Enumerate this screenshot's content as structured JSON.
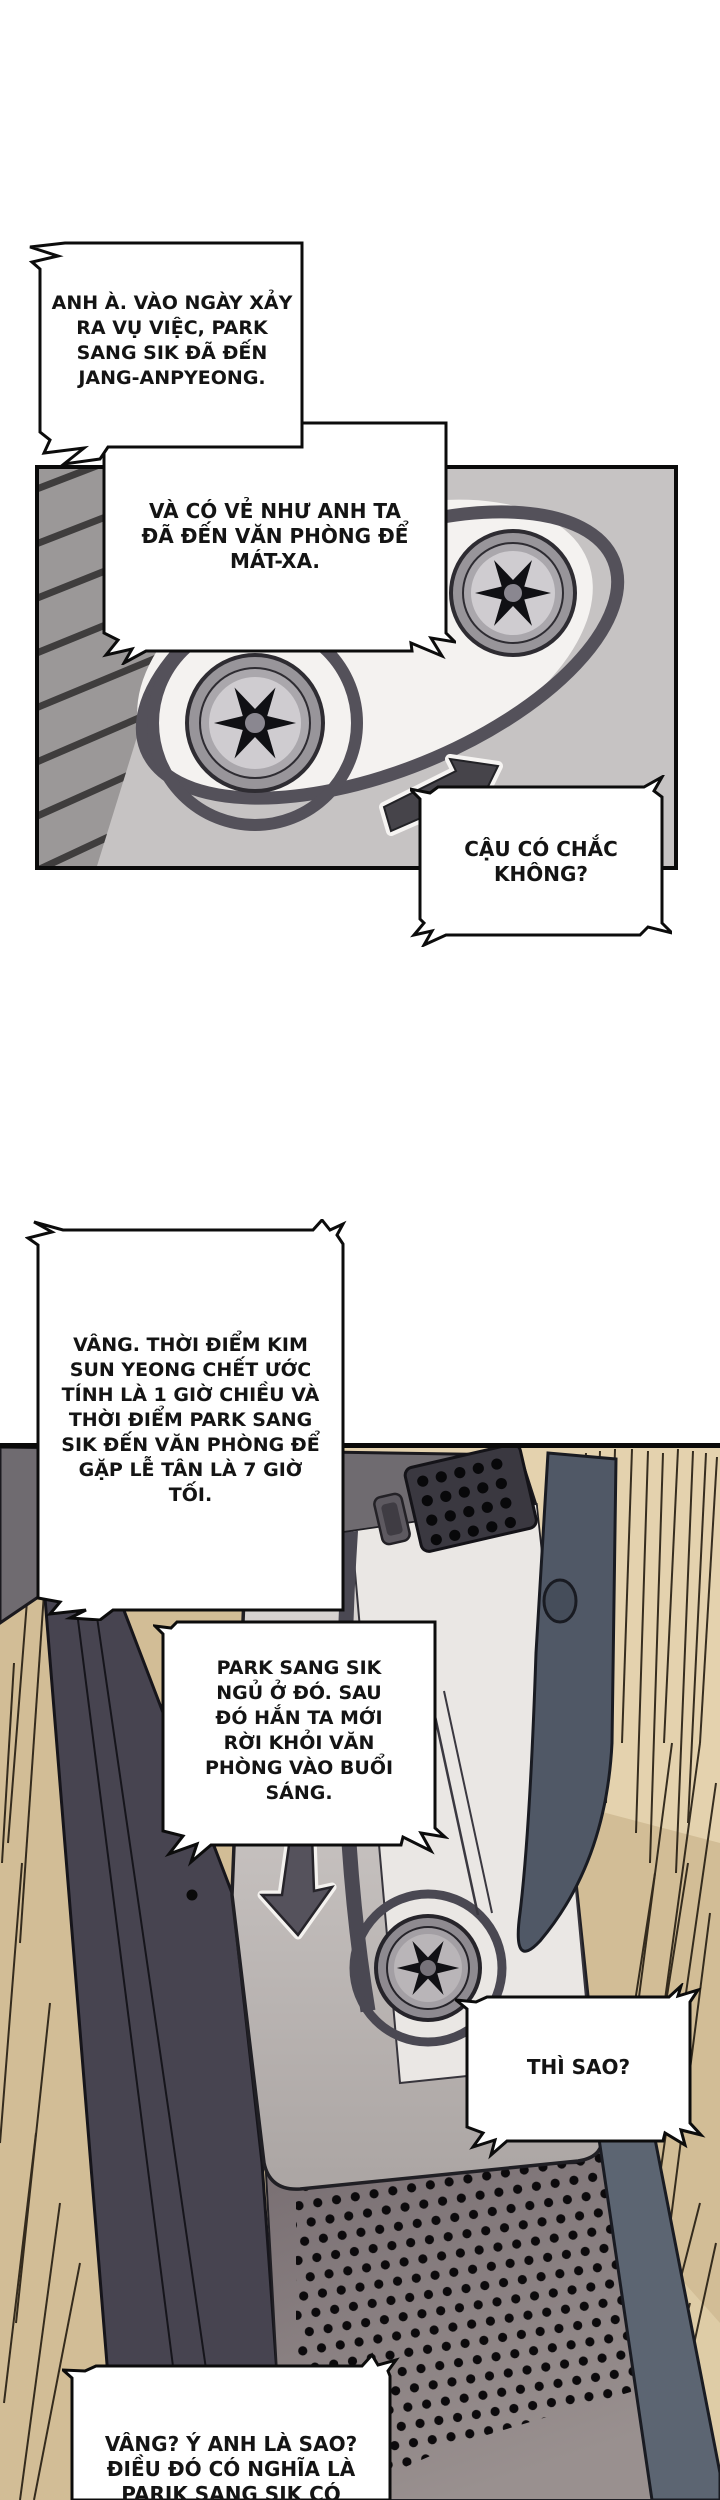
{
  "bubbles": {
    "b1": {
      "lines": [
        "ANH À. VÀO NGÀY XẢY",
        "RA VỤ VIỆC, PARK",
        "SANG SIK ĐÃ ĐẾN",
        "JANG-ANPYEONG."
      ]
    },
    "b2": {
      "lines": [
        "VÀ CÓ VẺ NHƯ ANH TA",
        "ĐÃ ĐẾN VĂN PHÒNG ĐỂ",
        "MÁT-XA."
      ]
    },
    "b3": {
      "lines": [
        "CẬU CÓ CHẮC",
        "KHÔNG?"
      ]
    },
    "b4": {
      "lines": [
        "VÂNG. THỜI ĐIỂM KIM",
        "SUN YEONG CHẾT ƯỚC",
        "TÍNH LÀ 1 GIỜ CHIỀU VÀ",
        "THỜI ĐIỂM PARK SANG",
        "SIK ĐẾN VĂN PHÒNG ĐỂ",
        "GẶP LỄ TÂN LÀ 7 GIỜ",
        "TỐI."
      ]
    },
    "b5": {
      "lines": [
        "PARK SANG SIK",
        "NGỦ Ở ĐÓ. SAU",
        "ĐÓ HẮN TA MỚI",
        "RỜI KHỎI VĂN",
        "PHÒNG VÀO BUỔI",
        "SÁNG."
      ]
    },
    "b6": {
      "lines": [
        "THÌ SAO?"
      ]
    },
    "b7": {
      "lines": [
        "VÂNG? Ý ANH LÀ SAO?",
        "ĐIỀU ĐÓ CÓ NGHĨA LÀ",
        "PARIK SANG SIK CÓ"
      ]
    }
  },
  "icons": {
    "panel1_arrow": "arrow-up-right-icon",
    "panel2_arrow": "arrow-down-icon"
  },
  "colors": {
    "page_bg": "#ffffff",
    "cassette_body": "#c6c3c3",
    "tape_band": "#54515a",
    "hub_star": "#101014",
    "recorder_dark": "#6f6b70",
    "recorder_clip": "#505866",
    "door_light": "#d9d5d3",
    "speaker_face": "#7a7074",
    "wood_background": "#d2bd96",
    "speed_line": "#241c10"
  }
}
